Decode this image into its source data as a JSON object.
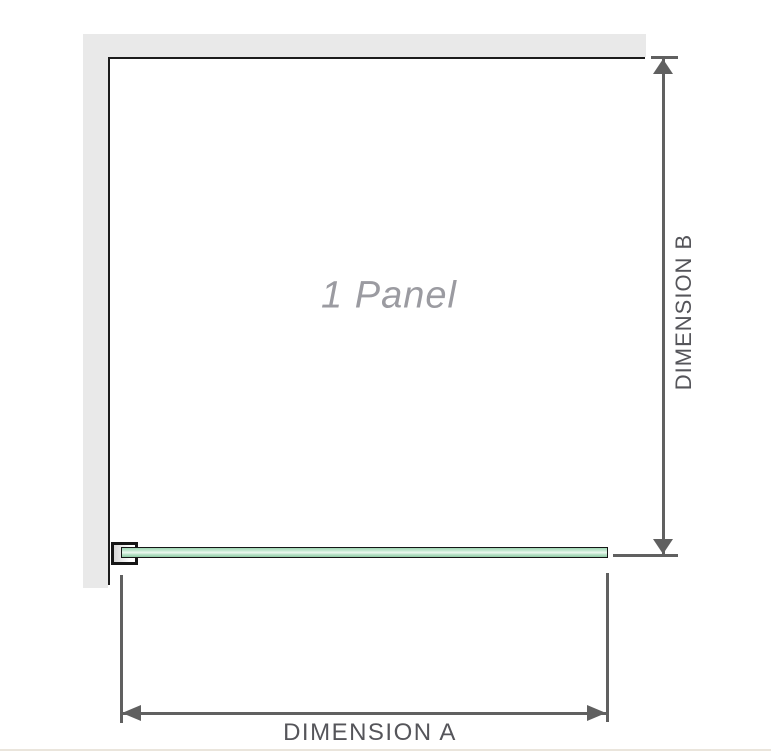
{
  "diagram": {
    "panel_label": "1 Panel",
    "dimension_a_label": "DIMENSION A",
    "dimension_b_label": "DIMENSION B",
    "colors": {
      "wall": "#e9e9e9",
      "panel_outline": "#1c1c1c",
      "dimension_lines": "#606060",
      "dimension_text": "#55555a",
      "panel_label_text": "#9b9ba1",
      "glass_fill": "#aaddbc",
      "glass_highlight": "#edf9f1",
      "glass_border": "#161616",
      "footer_rule": "#eae5dc"
    }
  }
}
